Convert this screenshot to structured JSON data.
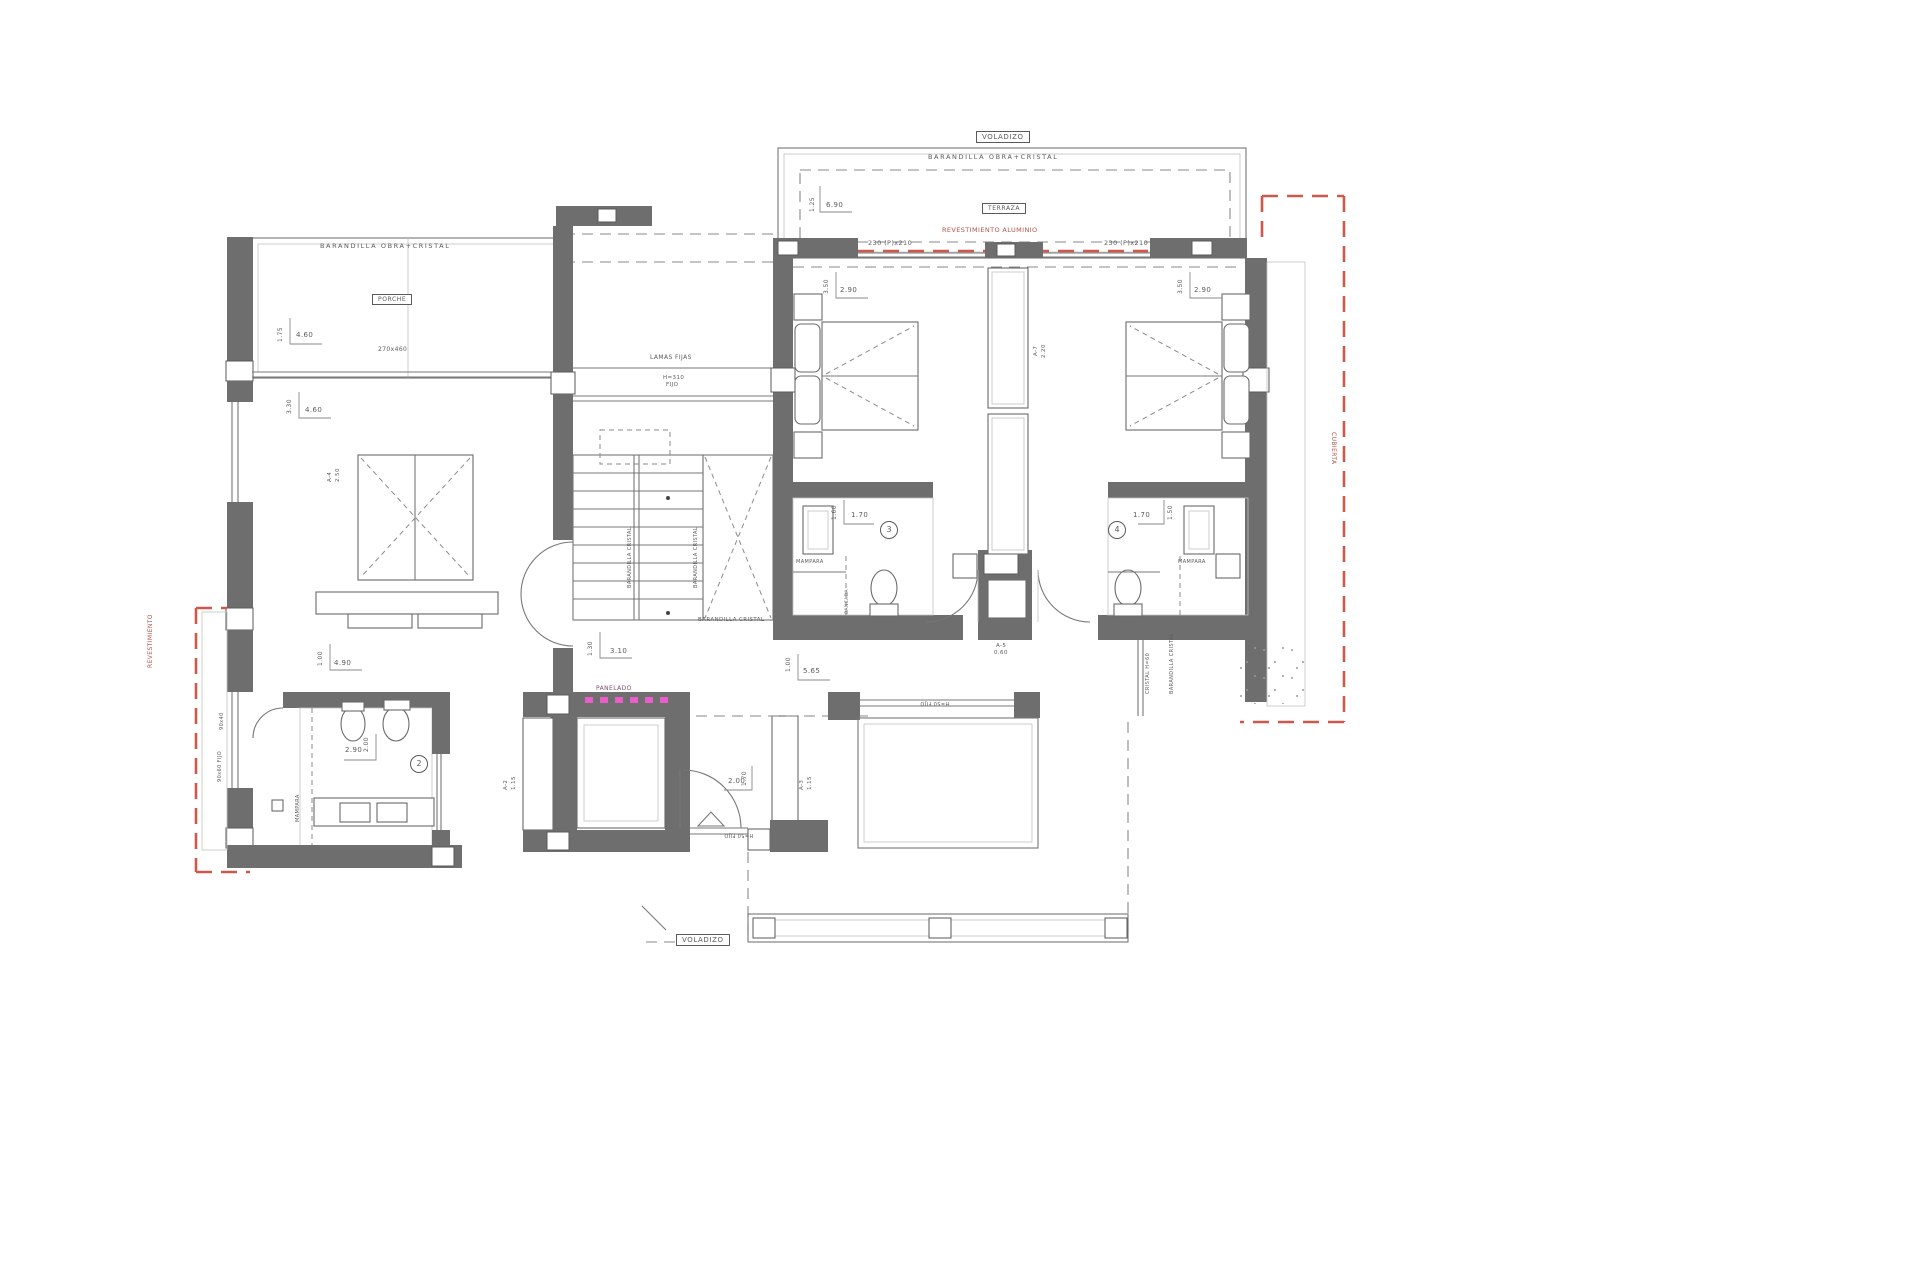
{
  "plan_title": "Upper floor plan",
  "colors": {
    "wall": "#6e6e6e",
    "red_dashed": "#cd594b",
    "magenta_panel": "#ea5ec9",
    "line": "#777777"
  },
  "boxes": {
    "voladizo": "VOLADIZO",
    "terraza": "TERRAZA",
    "porche": "PORCHE"
  },
  "railings": {
    "obra_cristal": "BARANDILLA OBRA+CRISTAL",
    "cristal": "BARANDILLA CRISTAL",
    "cristal_h60": "CRISTAL H=60",
    "lamas": "LAMAS FIJAS",
    "h310": "H=310",
    "fijo": "FIJO",
    "h50": "H=50 FIJO",
    "mampara": "MAMPARA",
    "panelado": "PANELADO",
    "revest_alu": "REVESTIMIENTO ALUMINIO",
    "revestimiento": "REVESTIMIENTO",
    "cubierta": "CUBIERTA",
    "bancada": "BANCADA"
  },
  "windows": {
    "w230": "230 (P)x210",
    "w270": "270x460",
    "w90x40": "90x40",
    "w90x60": "90x60 FIJO"
  },
  "dims": {
    "d125": "1.25",
    "d690": "6.90",
    "d175": "1.75",
    "d460": "4.60",
    "d330": "3.30",
    "d350": "3.50",
    "d290": "2.90",
    "d160": "1.60",
    "d170": "1.70",
    "d150": "1.50",
    "d200": "2.00",
    "d100": "1.00",
    "d490": "4.90",
    "d130": "1.30",
    "d310": "3.10",
    "d565": "5.65"
  },
  "closets": {
    "a7": "A-7",
    "a7v": "2.20",
    "a5": "A-5",
    "a5v": "0.60",
    "a4": "A-4",
    "a4v": "2.50",
    "a2": "A-2",
    "a2v": "1.15",
    "a3": "A-3",
    "a3v": "1.15"
  },
  "rooms": {
    "n2": "2",
    "n3": "3",
    "n4": "4"
  }
}
